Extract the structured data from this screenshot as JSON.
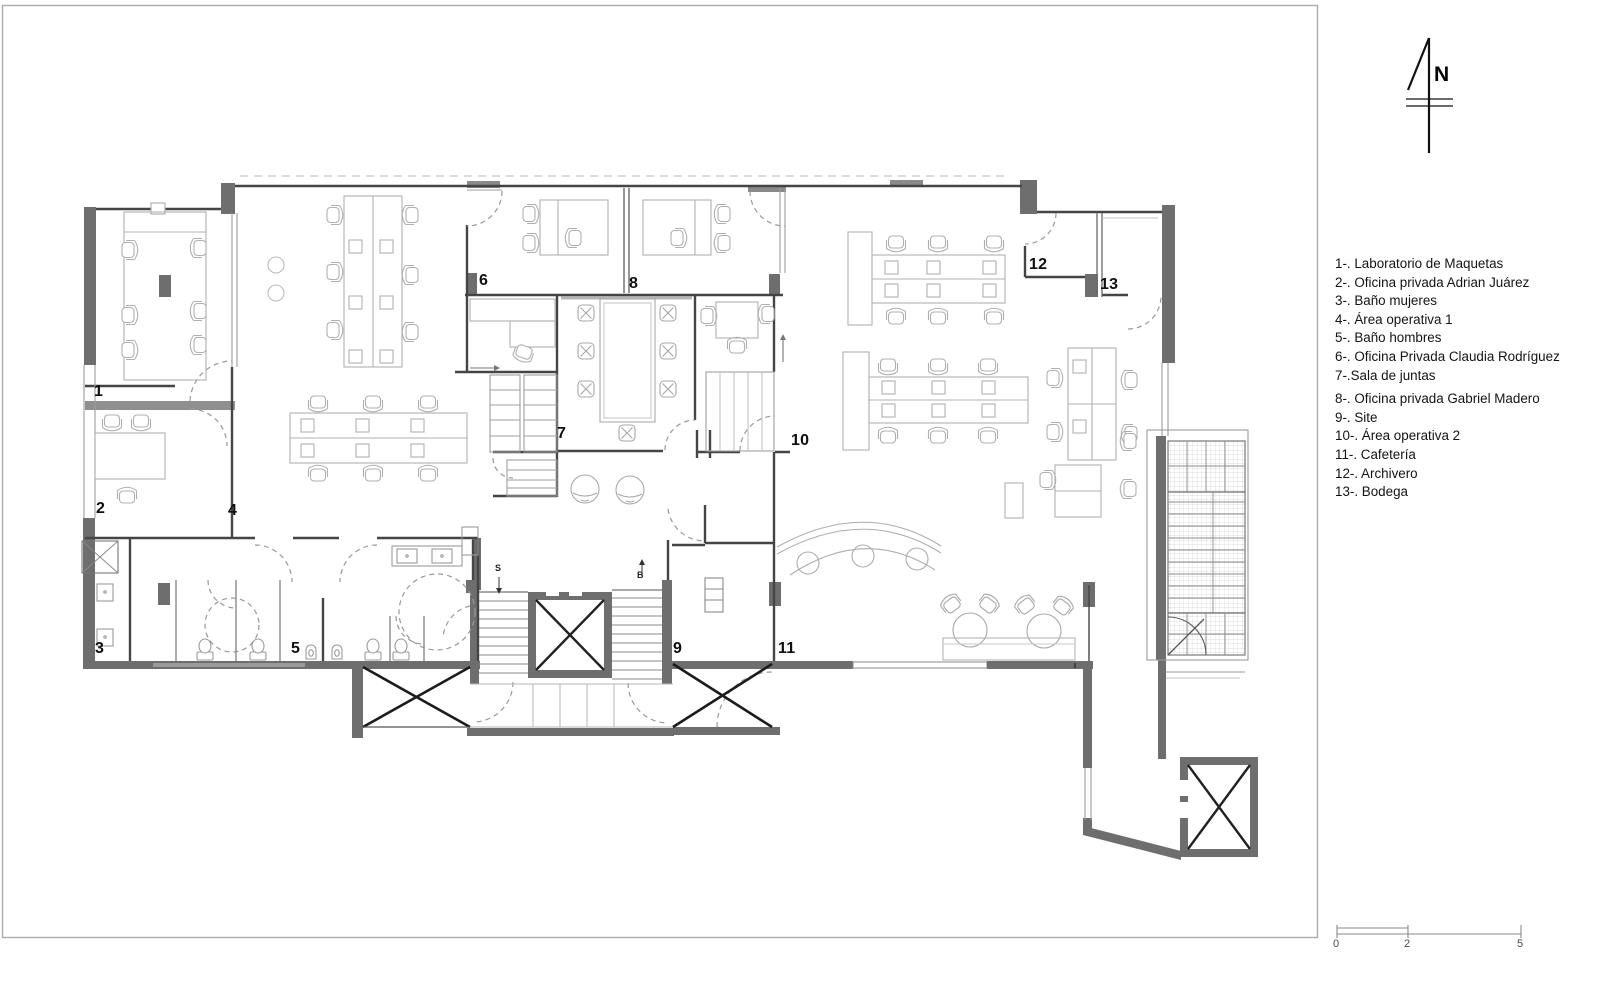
{
  "sheet": {
    "bg": "#ffffff",
    "frame_color": "#ababab"
  },
  "north": {
    "label": "N",
    "x": 1434,
    "y": 63
  },
  "legend": {
    "items": [
      "1-. Laboratorio de Maquetas",
      "2-. Oficina privada Adrian Juárez",
      "3-. Baño mujeres",
      "4-. Área operativa 1",
      "5-. Baño hombres",
      "6-. Oficina Privada Claudia Rodríguez",
      "7-.Sala de juntas",
      "8-. Oficina privada Gabriel Madero",
      "9-. Site",
      "10-. Área operativa 2",
      "11-. Cafetería",
      "12-. Archivero",
      "13-. Bodega"
    ]
  },
  "scale_bar": {
    "labels": [
      {
        "text": "0",
        "x": 1333,
        "y": 938
      },
      {
        "text": "2",
        "x": 1404,
        "y": 938
      },
      {
        "text": "5",
        "x": 1517,
        "y": 938
      }
    ]
  },
  "plan": {
    "room_labels": [
      {
        "text": "1",
        "x": 94,
        "y": 383
      },
      {
        "text": "2",
        "x": 96,
        "y": 500
      },
      {
        "text": "3",
        "x": 95,
        "y": 640
      },
      {
        "text": "4",
        "x": 228,
        "y": 502
      },
      {
        "text": "5",
        "x": 291,
        "y": 640
      },
      {
        "text": "6",
        "x": 479,
        "y": 272
      },
      {
        "text": "7",
        "x": 557,
        "y": 425
      },
      {
        "text": "8",
        "x": 629,
        "y": 275
      },
      {
        "text": "9",
        "x": 673,
        "y": 640
      },
      {
        "text": "10",
        "x": 791,
        "y": 432
      },
      {
        "text": "11",
        "x": 778,
        "y": 640
      },
      {
        "text": "12",
        "x": 1029,
        "y": 256
      },
      {
        "text": "13",
        "x": 1100,
        "y": 276
      }
    ],
    "markers": [
      {
        "text": "S",
        "x": 495,
        "y": 563
      },
      {
        "text": "B",
        "x": 637,
        "y": 570
      }
    ],
    "colors": {
      "wall": "#6e6e6e",
      "wall_line": "#454545",
      "light_line": "#9d9d9d",
      "furniture": "#b0b0b0",
      "brace": "#1c1c1c",
      "door": "#999999"
    }
  }
}
